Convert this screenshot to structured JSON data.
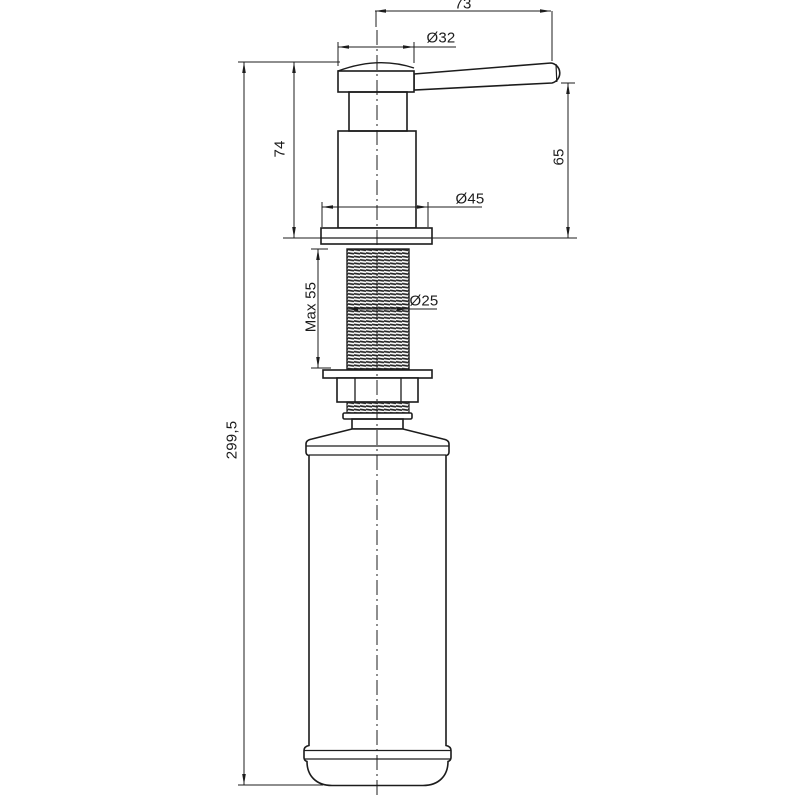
{
  "drawing": {
    "background_color": "#ffffff",
    "line_color": "#1c1c1c",
    "dimension_labels": {
      "handle_length": "73",
      "head_diameter": "Ø32",
      "pump_height": "74",
      "spout_height": "65",
      "flange_diameter": "Ø45",
      "thread_max_length": "Max 55",
      "thread_diameter": "Ø25",
      "total_height": "299,5"
    }
  }
}
